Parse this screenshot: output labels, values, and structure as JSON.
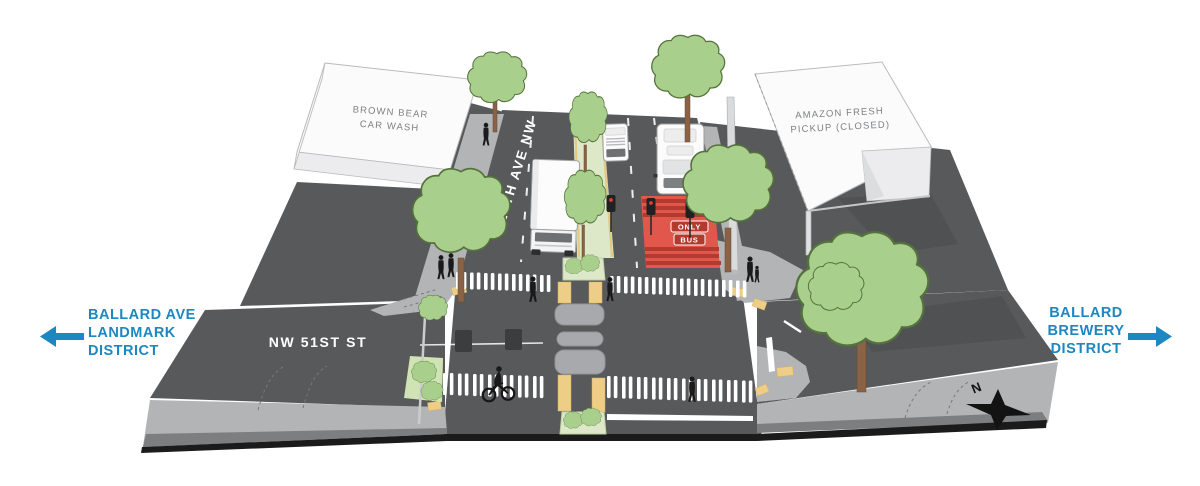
{
  "scene": {
    "buildings": {
      "car_wash": {
        "line1": "BROWN BEAR",
        "line2": "CAR WASH"
      },
      "amazon": {
        "line1": "AMAZON FRESH",
        "line2": "PICKUP (CLOSED)"
      }
    },
    "streets": {
      "vertical": "15TH AVE NW",
      "horizontal": "NW 51ST ST"
    },
    "bus_lane_marking": {
      "line1": "ONLY",
      "line2": "BUS"
    },
    "compass_north": "N"
  },
  "districts": {
    "left": {
      "line1": "BALLARD AVE",
      "line2": "LANDMARK",
      "line3": "DISTRICT"
    },
    "right": {
      "line1": "BALLARD",
      "line2": "BREWERY",
      "line3": "DISTRICT"
    }
  },
  "colors": {
    "accent_blue": "#1d87c2",
    "road_gray": "#58595b",
    "road_shadow": "#4a4b4d",
    "sidewalk_gray": "#b2b4b6",
    "curb_gray": "#7c7e80",
    "edge_black": "#1b1b1c",
    "building_white": "#fbfbfb",
    "building_text_gray": "#7e8083",
    "tree_green": "#a8cf8b",
    "tree_outline": "#55713d",
    "trunk_brown": "#8a6246",
    "median_green": "#dce8c8",
    "tactile_yellow": "#eecd86",
    "island_gray": "#a7a9ac",
    "bus_lane_red": "#e2574b",
    "bus_lane_red_dark": "#b23a2f",
    "marking_white": "#ffffff",
    "figure_black": "#1a1a1b"
  }
}
